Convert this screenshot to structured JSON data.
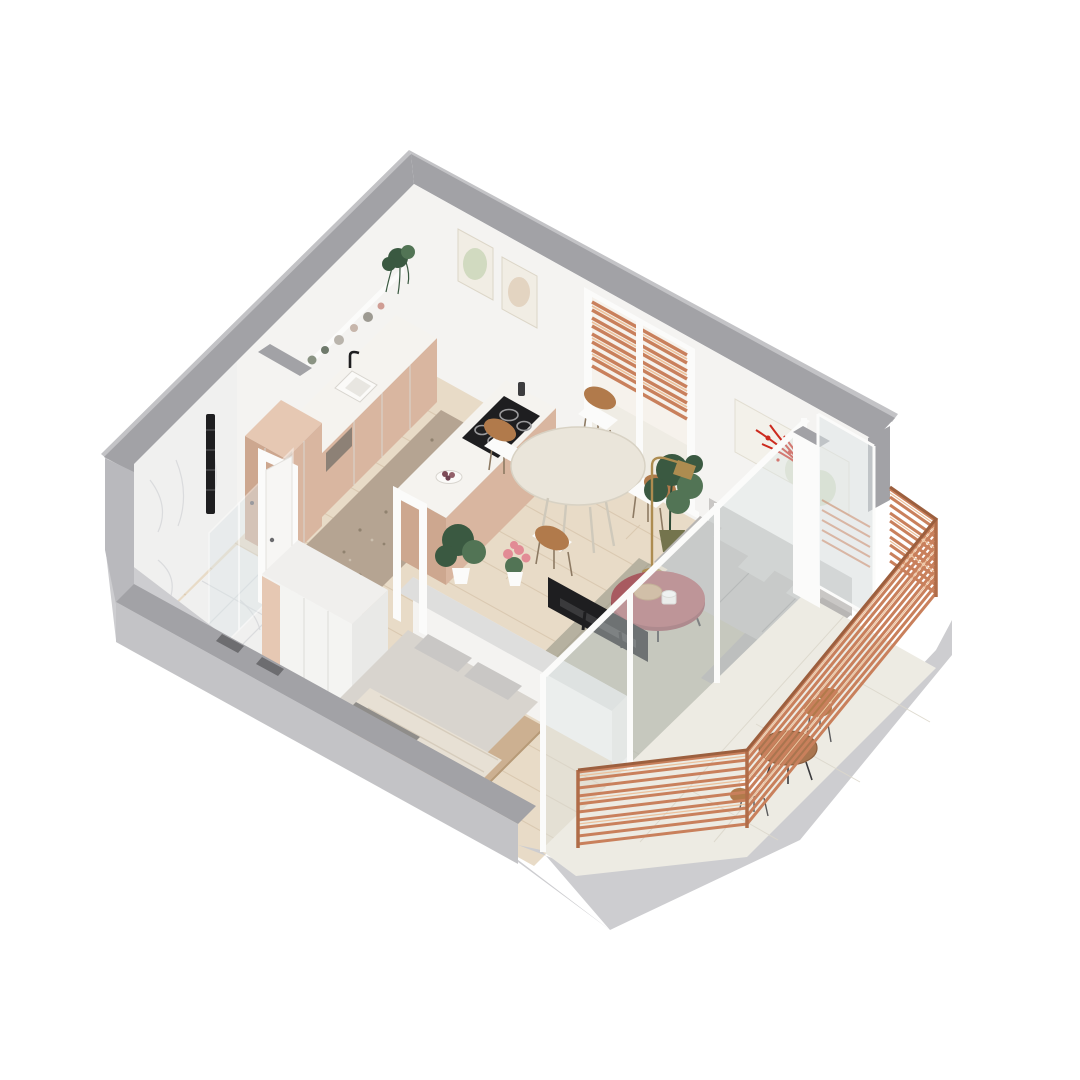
{
  "title": "3D isometric floor plan render of a studio apartment with balcony",
  "palette": {
    "bg": "#ffffff",
    "wall_top": "#a2a2a6",
    "wall_outer": "#c3c3c6",
    "wall_white": "#f4f3f1",
    "wall_shade": "#e9e7e4",
    "plinth": "#cdcdd0",
    "plinth_dark": "#b9b9bd",
    "marble": "#f0f0ef",
    "marble_vein": "#d5d6d8",
    "wood_floor": "#e8dbc7",
    "wood_plank": "#d8c6ae",
    "terrazzo": "#b5a492",
    "terrazzo_dot": "#90826f",
    "cab_beige": "#d9b6a0",
    "cab_beige_dark": "#cda78f",
    "cab_beige_light": "#e6c8b3",
    "counter_white": "#f5f3ef",
    "black": "#1e1e20",
    "sofa_gray": "#b8b6b4",
    "sofa_light": "#c9c7c5",
    "sofa_dark": "#a5a3a1",
    "rug_sage": "#b6b1a0",
    "maroon": "#a85a60",
    "maroon_dark": "#8c474f",
    "copper": "#c9805c",
    "copper_light": "#ecc19c",
    "glass": "#dde6e8",
    "frame_white": "#fbfbfa",
    "green_dark": "#3a5941",
    "green_mid": "#527455",
    "pot_olive": "#74744d",
    "brass": "#ad8c50",
    "wood_chair": "#b17a4b",
    "wood_table": "#a9754f",
    "pink": "#e28b95",
    "art_red": "#cc2a1e",
    "art_green": "#c9d4b6",
    "bedding": "#d8d4ce",
    "bedding_light": "#e7e0d4",
    "bed_wood": "#ccb091",
    "balcony_tile": "#edebe3",
    "balcony_tile_line": "#dcd8cc"
  },
  "scene": {
    "type": "isometric-apartment-render",
    "rooms": [
      {
        "name": "kitchen",
        "items": [
          "wall shelf with vessels",
          "hanging plant",
          "two framed artworks",
          "counter with sink and faucet",
          "dishwasher",
          "tall beige cabinet",
          "island with cooktop",
          "fruit bowl",
          "terrazzo rug"
        ]
      },
      {
        "name": "dining",
        "items": [
          "round table",
          "four chairs",
          "window with copper blinds",
          "fiddle-leaf fig plant",
          "brass floor lamp"
        ]
      },
      {
        "name": "living",
        "items": [
          "gray corner sofa",
          "sage rug",
          "maroon round coffee table with trays",
          "abstract artwork with red splatter",
          "tv on half wall"
        ]
      },
      {
        "name": "bedroom",
        "items": [
          "double bed with gray bedding",
          "white wardrobe",
          "glass sliding door"
        ]
      },
      {
        "name": "bathroom",
        "items": [
          "marble walls",
          "marble tile floor",
          "walk-in shower glass",
          "black towel radiator",
          "white door"
        ]
      },
      {
        "name": "balcony",
        "items": [
          "copper wood-slat railing",
          "round wooden table",
          "two chairs",
          "light tile floor",
          "glass sliding wall"
        ]
      }
    ]
  }
}
